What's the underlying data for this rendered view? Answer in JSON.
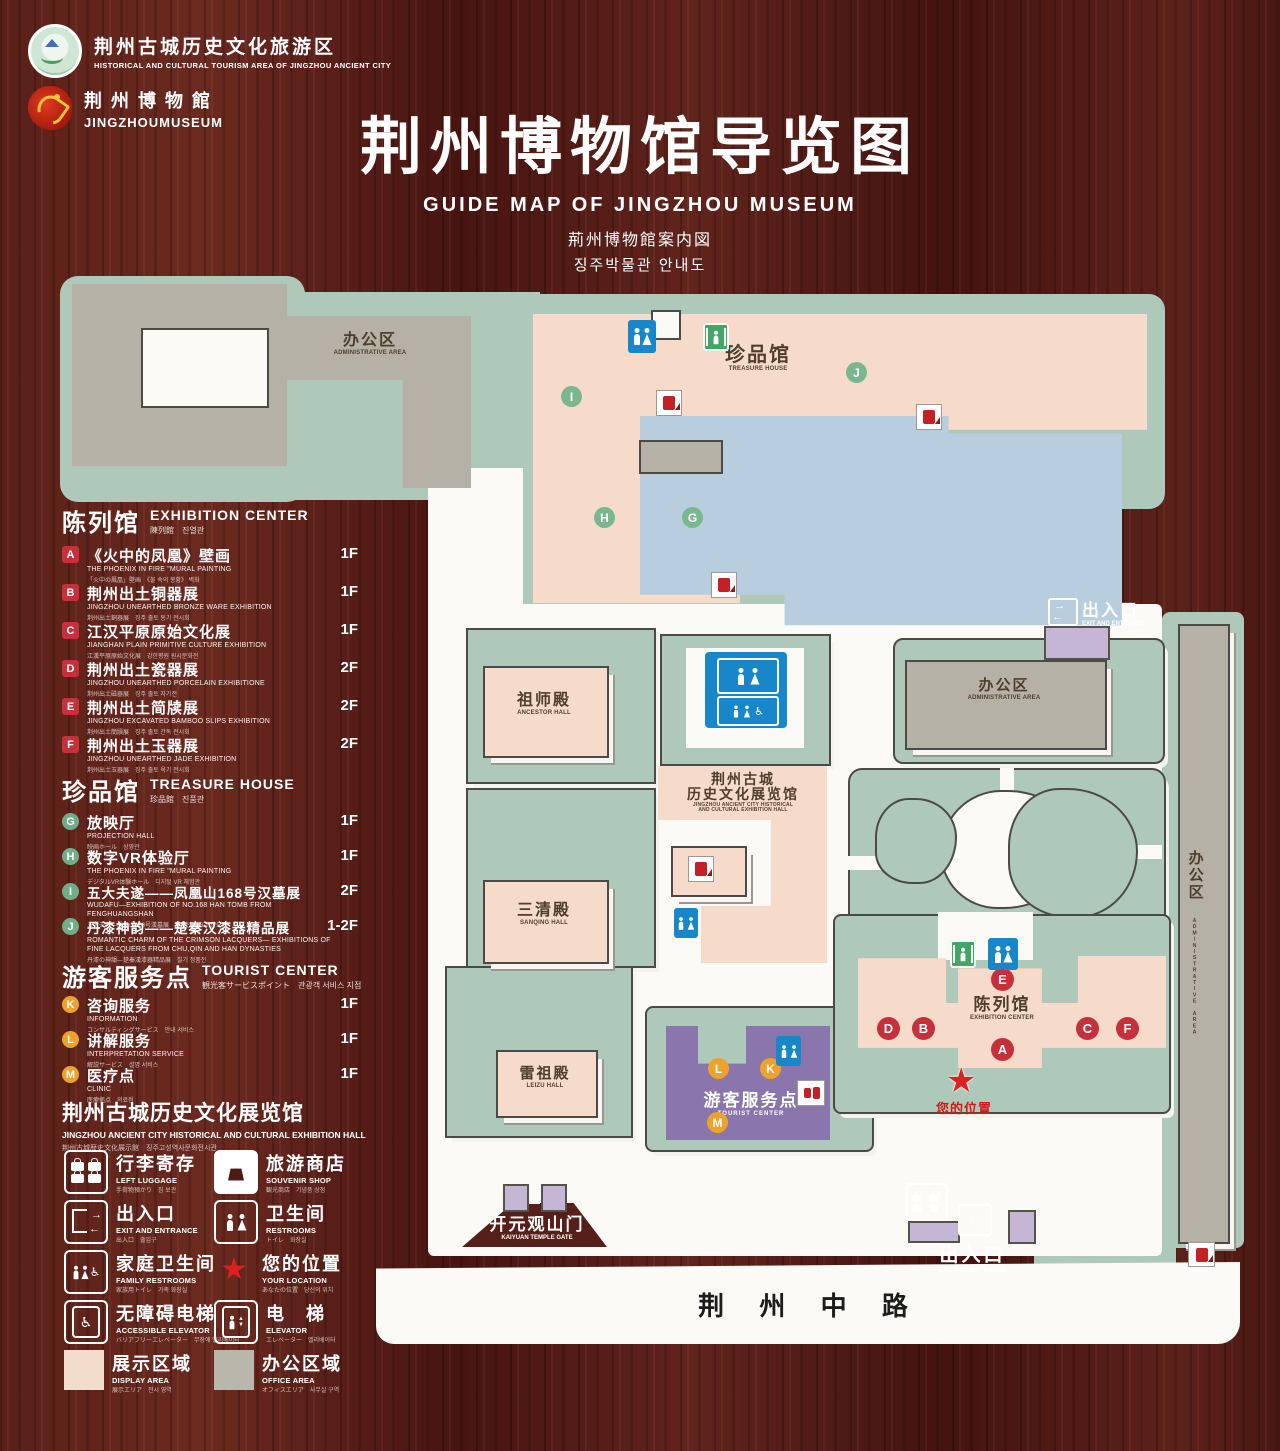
{
  "header": {
    "logo1_cn": "荆州古城历史文化旅游区",
    "logo1_en": "HISTORICAL AND CULTURAL TOURISM AREA OF JINGZHOU ANCIENT CITY",
    "logo2_cn": "荆 州 博 物 館",
    "logo2_en": "JINGZHOUMUSEUM",
    "title_cn": "荆州博物馆导览图",
    "title_en": "GUIDE MAP OF JINGZHOU MUSEUM",
    "title_jp": "荊州博物館案内図",
    "title_kr": "징주박물관 안내도"
  },
  "legend": {
    "sections": [
      {
        "title_cn": "陈列馆",
        "title_en": "EXHIBITION CENTER",
        "title_sub": "陳列館　진열관",
        "items": [
          {
            "letter": "A",
            "cn": "《火中的凤凰》壁画",
            "en": "THE PHOENIX IN FIRE \"MURAL PAINTING",
            "sub": "「火中の鳳凰」壁画　《불 속의 봉황》 벽화",
            "floor": "1F"
          },
          {
            "letter": "B",
            "cn": "荆州出土铜器展",
            "en": "JINGZHOU UNEARTHED BRONZE WARE EXHIBITION",
            "sub": "荆州出土銅器展　징주 출토 동기 전시회",
            "floor": "1F"
          },
          {
            "letter": "C",
            "cn": "江汉平原原始文化展",
            "en": "JIANGHAN PLAIN PRIMITIVE CULTURE EXHIBITION",
            "sub": "江漢平原原始文化展　강한평원 원시문화전",
            "floor": "1F"
          },
          {
            "letter": "D",
            "cn": "荆州出土瓷器展",
            "en": "JINGZHOU UNEARTHED PORCELAIN EXHIBITIONE",
            "sub": "荆州出土磁器展　징주 출토 자기전",
            "floor": "2F"
          },
          {
            "letter": "E",
            "cn": "荆州出土简牍展",
            "en": "JINGZHOU EXCAVATED BAMBOO SLIPS EXHIBITION",
            "sub": "荆州出土簡牘展　징주 출토 간독 전시회",
            "floor": "2F"
          },
          {
            "letter": "F",
            "cn": "荆州出土玉器展",
            "en": "JINGZHOU UNEARTHED JADE EXHIBITION",
            "sub": "荆州出土玉器展　징주 출토 옥기 전시회",
            "floor": "2F"
          }
        ]
      },
      {
        "title_cn": "珍品馆",
        "title_en": "TREASURE HOUSE",
        "title_sub": "珍品館　진품관",
        "items": [
          {
            "letter": "G",
            "cn": "放映厅",
            "en": "PROJECTION HALL",
            "sub": "映画ホール　상영관",
            "floor": "1F"
          },
          {
            "letter": "H",
            "cn": "数字VR体验厅",
            "en": "THE PHOENIX IN FIRE \"MURAL PAINTING",
            "sub": "デジタルVR体験ホール　디지털 VR 체험관",
            "floor": "1F"
          },
          {
            "letter": "I",
            "cn": "五大夫遂——凤凰山168号汉墓展",
            "en": "WUDAFU—EXHIBITION OF NO.168 HAN TOMB FROM FENGHUANGSHAN",
            "sub": "五大夫遂—鳳凰山168号漢墓展　봉황산 168호 한묘전",
            "floor": "2F"
          },
          {
            "letter": "J",
            "cn": "丹漆神韵——楚秦汉漆器精品展",
            "en": "ROMANTIC CHARM OF THE CRIMSON LACQUERS— EXHIBITIONS OF FINE LACQUERS FROM CHU,QIN AND HAN DYNASTIES",
            "sub": "丹漆の神韻—楚秦漢漆器精品展　칠기 정품전",
            "floor": "1-2F"
          }
        ]
      },
      {
        "title_cn": "游客服务点",
        "title_en": "TOURIST CENTER",
        "title_sub": "観光客サービスポイント　관광객 서비스 지점",
        "items": [
          {
            "letter": "K",
            "cn": "咨询服务",
            "en": "INFORMATION",
            "sub": "コンサルティングサービス　안내 서비스",
            "floor": "1F"
          },
          {
            "letter": "L",
            "cn": "讲解服务",
            "en": "INTERPRETATION SERVICE",
            "sub": "解説サービス　설명 서비스",
            "floor": "1F"
          },
          {
            "letter": "M",
            "cn": "医疗点",
            "en": "CLINIC",
            "sub": "医療拠点　의료점",
            "floor": "1F"
          }
        ]
      }
    ],
    "hall_cn": "荆州古城历史文化展览馆",
    "hall_en": "JINGZHOU ANCIENT CITY HISTORICAL AND CULTURAL EXHIBITION HALL",
    "hall_sub": "荆州古城歴史文化展示館　징주고성역사문화전시관",
    "icon_items": [
      {
        "icon": "left-luggage-icon",
        "cn": "行李寄存",
        "en": "LEFT LUGGAGE",
        "sub": "手荷物預かり　짐 보관"
      },
      {
        "icon": "souvenir-shop-icon",
        "cn": "旅游商店",
        "en": "SOUVENIR SHOP",
        "sub": "観光商店　기념품 상점"
      },
      {
        "icon": "exit-entrance-icon",
        "cn": "出入口",
        "en": "EXIT AND ENTRANCE",
        "sub": "出入口　출입구"
      },
      {
        "icon": "restrooms-icon",
        "cn": "卫生间",
        "en": "RESTROOMS",
        "sub": "トイレ　화장실"
      },
      {
        "icon": "family-restrooms-icon",
        "cn": "家庭卫生间",
        "en": "FAMILY RESTROOMS",
        "sub": "家族用トイレ　가족 화장실"
      },
      {
        "icon": "your-location-icon",
        "cn": "您的位置",
        "en": "YOUR LOCATION",
        "sub": "あなたの位置　당신의 위치"
      },
      {
        "icon": "accessible-elevator-icon",
        "cn": "无障碍电梯",
        "en": "ACCESSIBLE ELEVATOR",
        "sub": "バリアフリーエレベーター　무장애 엘리베이터"
      },
      {
        "icon": "elevator-icon",
        "cn": "电　梯",
        "en": "ELEVATOR",
        "sub": "エレベーター　엘리베이터"
      },
      {
        "icon": "display-area-swatch",
        "cn": "展示区域",
        "en": "DISPLAY AREA",
        "sub": "展示エリア　전시 영역"
      },
      {
        "icon": "office-area-swatch",
        "cn": "办公区域",
        "en": "OFFICE AREA",
        "sub": "オフィスエリア　사무실 구역"
      }
    ]
  },
  "map": {
    "admin_cn": "办公区",
    "admin_en": "ADMINISTRATIVE AREA",
    "treasure_cn": "珍品馆",
    "treasure_en": "TREASURE HOUSE",
    "ancestor_cn": "祖师殿",
    "ancestor_en": "ANCESTOR HALL",
    "sanqing_cn": "三清殿",
    "sanqing_en": "SANQING HALL",
    "leizu_cn": "雷祖殿",
    "leizu_en": "LEIZU HALL",
    "hist_cn1": "荆州古城",
    "hist_cn2": "历史文化展览馆",
    "hist_en1": "JINGZHOU ANCIENT CITY HISTORICAL",
    "hist_en2": "AND CULTURAL EXHIBITION HALL",
    "tourist_cn": "游客服务点",
    "tourist_en": "TOURIST CENTER",
    "exhib_cn": "陈列馆",
    "exhib_en": "EXHIBITION CENTER",
    "exit_cn": "出入口",
    "exit_en": "EXIT AND ENTRANCE",
    "gate_cn": "开元观山门",
    "gate_en": "KAIYUAN TEMPLE GATE",
    "loc_cn": "您的位置",
    "road": "荆 州 中 路",
    "markers_treasure": [
      "I",
      "J",
      "H",
      "G"
    ],
    "markers_exhibition": [
      "E",
      "D",
      "B",
      "A",
      "C",
      "F"
    ],
    "markers_tourist": [
      "L",
      "K",
      "M"
    ]
  },
  "colors": {
    "wood": "#5a2019",
    "ground_green": "#aec8b9",
    "display_pink": "#f6dbca",
    "office_gray": "#b5b1a6",
    "tourist_purple": "#8a76ad",
    "pond_blue": "#b8cede",
    "restroom_blue": "#1887c9",
    "elevator_green": "#43a566",
    "marker_red": "#c5303a",
    "marker_green": "#79b88f",
    "marker_orange": "#eda32b",
    "star_red": "#e02020"
  }
}
